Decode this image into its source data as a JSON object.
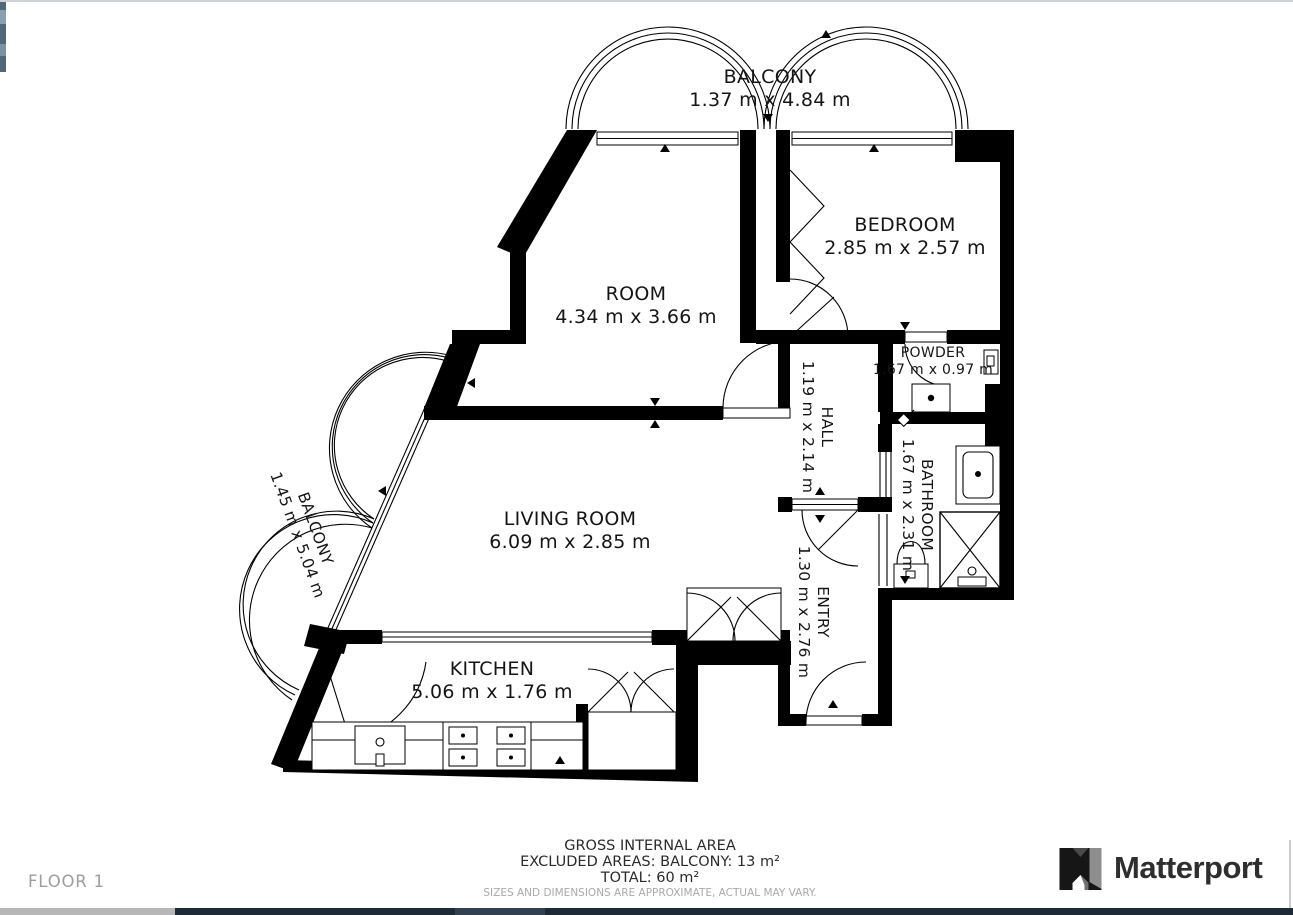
{
  "title": "Floor plan",
  "rooms": {
    "balcony_top": {
      "name": "BALCONY",
      "dims": "1.37 m x 4.84 m"
    },
    "bedroom": {
      "name": "BEDROOM",
      "dims": "2.85 m x 2.57 m"
    },
    "room": {
      "name": "ROOM",
      "dims": "4.34 m x 3.66 m"
    },
    "powder": {
      "name": "POWDER",
      "dims": "1.67 m x 0.97 m"
    },
    "hall": {
      "name": "HALL",
      "dims": "1.19 m x 2.14 m"
    },
    "bathroom": {
      "name": "BATHROOM",
      "dims": "1.67 m x 2.31 m"
    },
    "living_room": {
      "name": "LIVING ROOM",
      "dims": "6.09 m x 2.85 m"
    },
    "entry": {
      "name": "ENTRY",
      "dims": "1.30 m x 2.76 m"
    },
    "kitchen": {
      "name": "KITCHEN",
      "dims": "5.06 m x 1.76 m"
    },
    "balcony_left": {
      "name": "BALCONY",
      "dims": "1.45 m x 5.04 m"
    }
  },
  "footer": {
    "gross": "GROSS INTERNAL AREA",
    "excluded": "EXCLUDED AREAS: BALCONY: 13 m²",
    "total": "TOTAL: 60 m²",
    "disclaimer": "SIZES AND DIMENSIONS ARE APPROXIMATE, ACTUAL MAY VARY."
  },
  "floor_label": "FLOOR 1",
  "brand": {
    "name": "Matterport",
    "icon": "matterport-m-icon"
  },
  "colors": {
    "wall": "#000000",
    "background": "#ffffff",
    "muted_text": "#9e9e9e",
    "disclaimer_text": "#a9a9a9",
    "brand_text": "#2e2e2e",
    "scrollbar_gray": "#b7b7b7",
    "scrollbar_dark": "#1f2a37"
  }
}
